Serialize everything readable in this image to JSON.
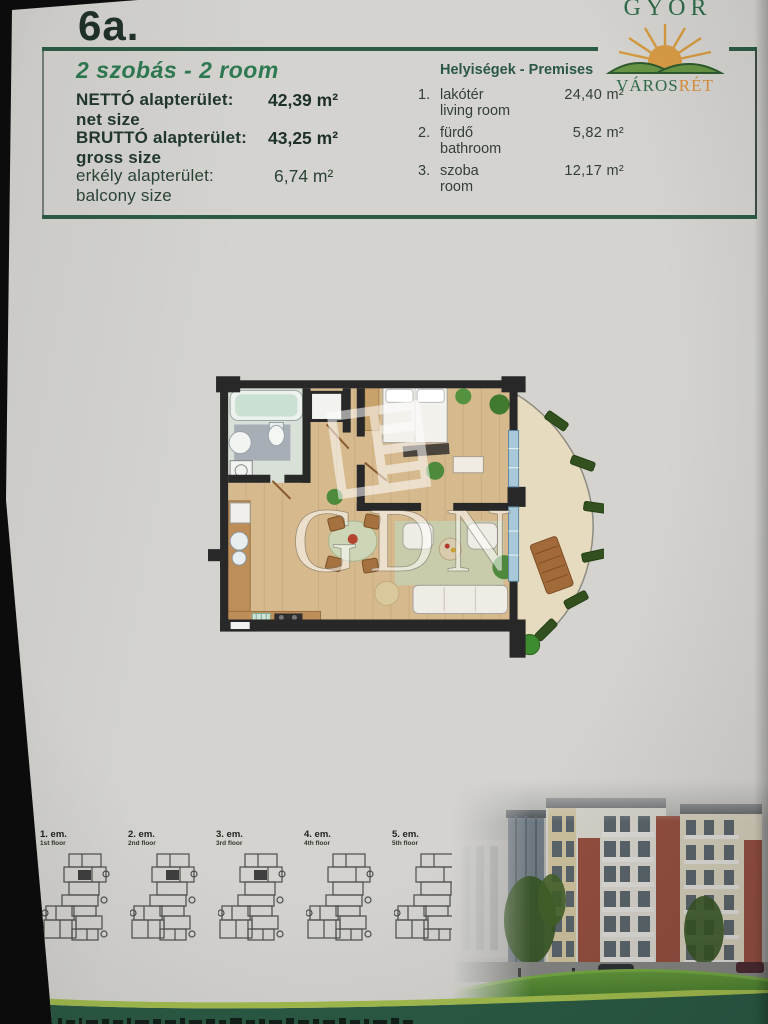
{
  "page": {
    "unit_label": "6a."
  },
  "logo": {
    "city": "GYŐR",
    "brand_part1": "VÁROS",
    "brand_part2": "RÉT",
    "sun_icon": "sun-over-hills"
  },
  "summary": {
    "title": "2 szobás - 2 room",
    "rows": [
      {
        "label_hu": "NETTÓ alapterület:",
        "label_en": "net size",
        "value": "42,39 m²"
      },
      {
        "label_hu": "BRUTTÓ alapterület:",
        "label_en": "gross size",
        "value": "43,25 m²"
      },
      {
        "label_hu": "erkély alapterület:",
        "label_en": "balcony size",
        "value": "6,74 m²"
      }
    ]
  },
  "premises": {
    "title": "Helyiségek - Premises",
    "items": [
      {
        "num": "1.",
        "name_hu": "lakótér",
        "name_en": "living room",
        "value": "24,40 m²"
      },
      {
        "num": "2.",
        "name_hu": "fürdő",
        "name_en": "bathroom",
        "value": "5,82 m²"
      },
      {
        "num": "3.",
        "name_hu": "szoba",
        "name_en": "room",
        "value": "12,17 m²"
      }
    ]
  },
  "floorplan": {
    "watermark": "GDN"
  },
  "floors": [
    {
      "label_hu": "1. em.",
      "label_en": "1st floor",
      "highlight": true
    },
    {
      "label_hu": "2. em.",
      "label_en": "2nd floor",
      "highlight": true
    },
    {
      "label_hu": "3. em.",
      "label_en": "3rd floor",
      "highlight": true
    },
    {
      "label_hu": "4. em.",
      "label_en": "4th floor",
      "highlight": false
    },
    {
      "label_hu": "5. em.",
      "label_en": "5th floor",
      "highlight": false
    }
  ],
  "colors": {
    "accent_green": "#2d5c45",
    "logo_orange": "#d78f3c",
    "band_light_green": "#a2bc4e",
    "highlight_dark": "#3f3f3f"
  }
}
